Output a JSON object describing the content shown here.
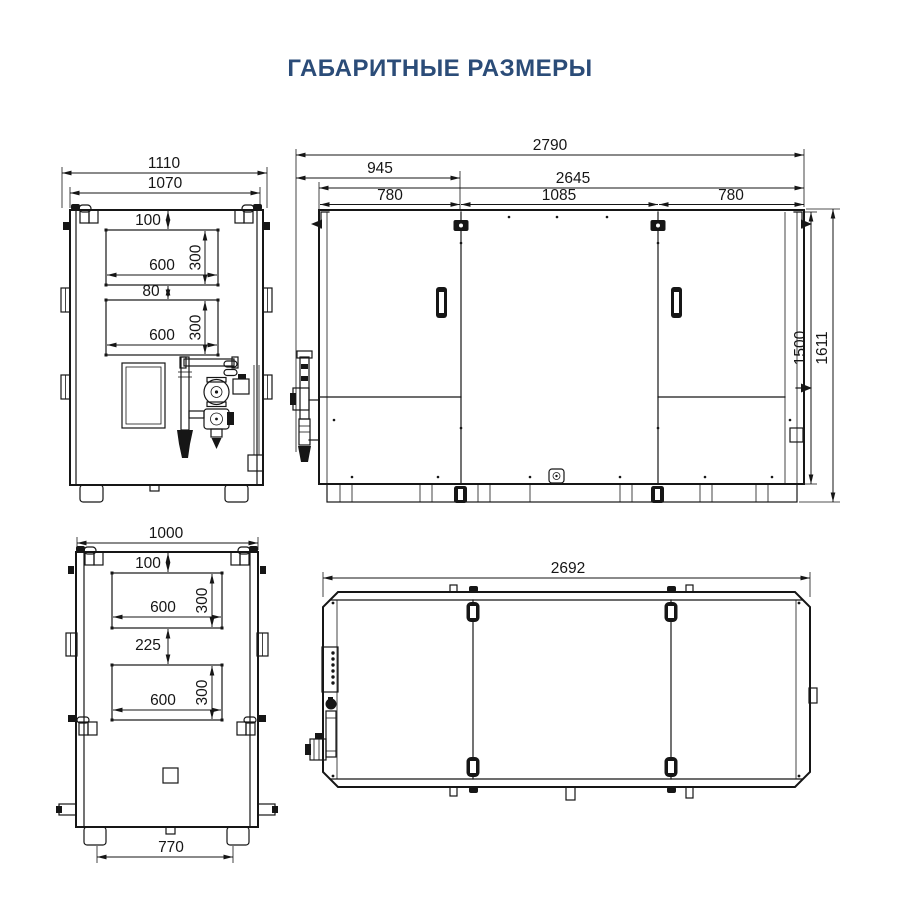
{
  "title": "ГАБАРИТНЫЕ РАЗМЕРЫ",
  "colors": {
    "title_text": "#2B4C78",
    "drawing_lines": "#161616",
    "background": "#FFFFFF"
  },
  "views": {
    "front": {
      "dims": {
        "outer_width": "1110",
        "frame_width": "1070",
        "opening_top_offset": "100",
        "opening1_width": "600",
        "opening1_height": "300",
        "opening_gap": "80",
        "opening2_width": "600",
        "opening2_height": "300"
      }
    },
    "side": {
      "dims": {
        "overall_length": "2790",
        "service_zone_length": "945",
        "body_length": "2645",
        "panel1_width": "780",
        "panel2_width": "1085",
        "panel3_width": "780",
        "body_height": "1500",
        "overall_height": "1611"
      }
    },
    "rear": {
      "dims": {
        "width": "1000",
        "opening_top_offset": "100",
        "opening1_width": "600",
        "opening1_height": "300",
        "opening_gap": "225",
        "opening2_width": "600",
        "opening2_height": "300",
        "feet_span": "770"
      }
    },
    "top": {
      "dims": {
        "length": "2692"
      }
    }
  }
}
